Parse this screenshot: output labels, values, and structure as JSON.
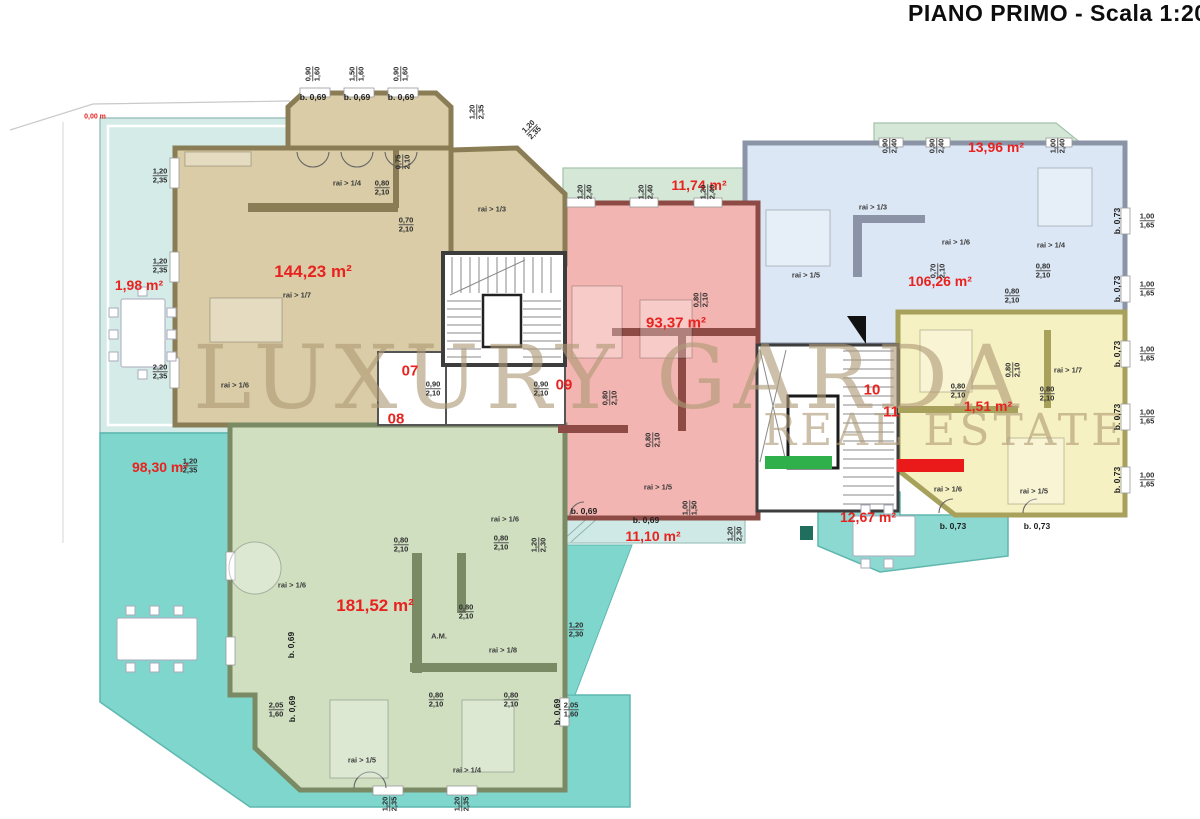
{
  "title": "PIANO PRIMO - Scala 1:200",
  "watermark": {
    "line1": "LUXURY GARDA",
    "line2": "REAL ESTATE"
  },
  "legend": {
    "available_color": "#2fb04a",
    "sold_color": "#ea1a1a"
  },
  "colors": {
    "terrace_light": "#d4ebe8",
    "terrace_turquoise": "#7fd6cd",
    "terrace_green": "#d5e8d8",
    "terrace_mid": "#8cd9d1",
    "stair_wall": "#3d3d3d",
    "area_text": "#e8221f"
  },
  "units": [
    {
      "number": "07",
      "area": "144,23 m²",
      "fill": "#d9cca6",
      "wall": "#8a7c54"
    },
    {
      "number": "08",
      "area": "181,52 m²",
      "fill": "#cfdfc0",
      "wall": "#798a64"
    },
    {
      "number": "09",
      "area": "93,37 m²",
      "fill": "#f2b5b1",
      "wall": "#8e4a45"
    },
    {
      "number": "10",
      "area": "106,26 m²",
      "fill": "#dce7f5",
      "wall": "#8a94a6"
    },
    {
      "number": "11",
      "area": "1,51 m²",
      "fill": "#f6f1c2",
      "wall": "#a8a15c"
    }
  ],
  "terrace_areas": [
    "1,98 m²",
    "98,30 m²",
    "11,74 m²",
    "13,96 m²",
    "11,10 m²",
    "12,67 m²",
    "0,00 m"
  ],
  "labels": {
    "areas": [
      {
        "t": "144,23 m²",
        "x": 313,
        "y": 272,
        "fs": 17
      },
      {
        "t": "181,52 m²",
        "x": 375,
        "y": 606,
        "fs": 17
      },
      {
        "t": "93,37 m²",
        "x": 676,
        "y": 323,
        "fs": 15
      },
      {
        "t": "106,26 m²",
        "x": 940,
        "y": 281,
        "fs": 14
      },
      {
        "t": "13,96 m²",
        "x": 996,
        "y": 147,
        "fs": 14
      },
      {
        "t": "11,74 m²",
        "x": 699,
        "y": 185,
        "fs": 14
      },
      {
        "t": "1,98 m²",
        "x": 139,
        "y": 285,
        "fs": 14
      },
      {
        "t": "98,30 m²",
        "x": 160,
        "y": 467,
        "fs": 14
      },
      {
        "t": "11,10 m²",
        "x": 653,
        "y": 536,
        "fs": 14
      },
      {
        "t": "12,67 m²",
        "x": 868,
        "y": 517,
        "fs": 14
      },
      {
        "t": "1,51 m²",
        "x": 988,
        "y": 406,
        "fs": 14
      },
      {
        "t": "0,00 m",
        "x": 95,
        "y": 117,
        "fs": 7
      }
    ],
    "unit_numbers": [
      {
        "t": "07",
        "x": 410,
        "y": 371
      },
      {
        "t": "08",
        "x": 396,
        "y": 419
      },
      {
        "t": "09",
        "x": 564,
        "y": 385
      },
      {
        "t": "10",
        "x": 872,
        "y": 390
      },
      {
        "t": "11",
        "x": 891,
        "y": 412
      }
    ],
    "rai": [
      {
        "t": "rai > 1/4",
        "x": 347,
        "y": 183
      },
      {
        "t": "rai > 1/3",
        "x": 492,
        "y": 209
      },
      {
        "t": "rai > 1/7",
        "x": 297,
        "y": 295
      },
      {
        "t": "rai > 1/6",
        "x": 235,
        "y": 385
      },
      {
        "t": "rai > 1/6",
        "x": 505,
        "y": 519
      },
      {
        "t": "rai > 1/6",
        "x": 292,
        "y": 585
      },
      {
        "t": "rai > 1/8",
        "x": 503,
        "y": 650
      },
      {
        "t": "rai > 1/5",
        "x": 362,
        "y": 760
      },
      {
        "t": "rai > 1/4",
        "x": 467,
        "y": 770
      },
      {
        "t": "A.M.",
        "x": 439,
        "y": 636
      },
      {
        "t": "rai > 1/5",
        "x": 658,
        "y": 487
      },
      {
        "t": "rai > 1/3",
        "x": 873,
        "y": 207
      },
      {
        "t": "rai > 1/5",
        "x": 806,
        "y": 275
      },
      {
        "t": "rai > 1/6",
        "x": 956,
        "y": 242
      },
      {
        "t": "rai > 1/4",
        "x": 1051,
        "y": 245
      },
      {
        "t": "rai > 1/7",
        "x": 1068,
        "y": 370
      },
      {
        "t": "rai > 1/6",
        "x": 948,
        "y": 489
      },
      {
        "t": "rai > 1/5",
        "x": 1034,
        "y": 491
      }
    ],
    "doors": [
      {
        "t": "b. 0,69",
        "x": 313,
        "y": 97
      },
      {
        "t": "b. 0,69",
        "x": 357,
        "y": 97
      },
      {
        "t": "b. 0,69",
        "x": 401,
        "y": 97
      },
      {
        "t": "b. 0,69",
        "x": 584,
        "y": 511
      },
      {
        "t": "b. 0,69",
        "x": 646,
        "y": 520
      },
      {
        "t": "b. 0,69",
        "x": 291,
        "y": 645,
        "r": -90
      },
      {
        "t": "b. 0,69",
        "x": 292,
        "y": 709,
        "r": -90
      },
      {
        "t": "b. 0,69",
        "x": 557,
        "y": 712,
        "r": -90
      },
      {
        "t": "b. 0,73",
        "x": 953,
        "y": 526
      },
      {
        "t": "b. 0,73",
        "x": 1037,
        "y": 526
      },
      {
        "t": "b. 0,73",
        "x": 1117,
        "y": 221,
        "r": -90
      },
      {
        "t": "b. 0,73",
        "x": 1117,
        "y": 289,
        "r": -90
      },
      {
        "t": "b. 0,73",
        "x": 1117,
        "y": 354,
        "r": -90
      },
      {
        "t": "b. 0,73",
        "x": 1117,
        "y": 417,
        "r": -90
      },
      {
        "t": "b. 0,73",
        "x": 1117,
        "y": 480,
        "r": -90
      }
    ],
    "dims": [
      {
        "a": "0,90",
        "b": "1,60",
        "x": 313,
        "y": 74,
        "r": -90
      },
      {
        "a": "1,50",
        "b": "1,60",
        "x": 357,
        "y": 74,
        "r": -90
      },
      {
        "a": "0,90",
        "b": "1,60",
        "x": 401,
        "y": 74,
        "r": -90
      },
      {
        "a": "1,20",
        "b": "2,35",
        "x": 477,
        "y": 112,
        "r": -90
      },
      {
        "a": "1,20",
        "b": "2,35",
        "x": 532,
        "y": 130,
        "r": -45
      },
      {
        "a": "1,20",
        "b": "2,35",
        "x": 160,
        "y": 176
      },
      {
        "a": "1,20",
        "b": "2,35",
        "x": 160,
        "y": 266
      },
      {
        "a": "2,20",
        "b": "2,35",
        "x": 160,
        "y": 372
      },
      {
        "a": "1,20",
        "b": "2,35",
        "x": 190,
        "y": 466
      },
      {
        "a": "1,20",
        "b": "2,40",
        "x": 585,
        "y": 192,
        "r": -90
      },
      {
        "a": "1,20",
        "b": "2,40",
        "x": 646,
        "y": 192,
        "r": -90
      },
      {
        "a": "1,20",
        "b": "2,40",
        "x": 708,
        "y": 192,
        "r": -90
      },
      {
        "a": "0,90",
        "b": "2,40",
        "x": 890,
        "y": 146,
        "r": -90
      },
      {
        "a": "0,90",
        "b": "2,40",
        "x": 937,
        "y": 146,
        "r": -90
      },
      {
        "a": "1,00",
        "b": "2,40",
        "x": 1058,
        "y": 146,
        "r": -90
      },
      {
        "a": "1,00",
        "b": "1,65",
        "x": 1147,
        "y": 221
      },
      {
        "a": "1,00",
        "b": "1,65",
        "x": 1147,
        "y": 289
      },
      {
        "a": "1,00",
        "b": "1,65",
        "x": 1147,
        "y": 354
      },
      {
        "a": "1,00",
        "b": "1,65",
        "x": 1147,
        "y": 417
      },
      {
        "a": "1,00",
        "b": "1,65",
        "x": 1147,
        "y": 480
      },
      {
        "a": "0,80",
        "b": "2,10",
        "x": 382,
        "y": 188
      },
      {
        "a": "0,70",
        "b": "2,10",
        "x": 406,
        "y": 225
      },
      {
        "a": "0,75",
        "b": "2,10",
        "x": 403,
        "y": 162,
        "r": -90
      },
      {
        "a": "0,90",
        "b": "2,10",
        "x": 433,
        "y": 389
      },
      {
        "a": "0,90",
        "b": "2,10",
        "x": 541,
        "y": 389
      },
      {
        "a": "0,80",
        "b": "2,10",
        "x": 610,
        "y": 398,
        "r": -90
      },
      {
        "a": "0,80",
        "b": "2,10",
        "x": 653,
        "y": 440,
        "r": -90
      },
      {
        "a": "0,80",
        "b": "2,10",
        "x": 701,
        "y": 300,
        "r": -90
      },
      {
        "a": "0,70",
        "b": "2,10",
        "x": 938,
        "y": 271,
        "r": -90
      },
      {
        "a": "0,80",
        "b": "2,10",
        "x": 1043,
        "y": 271
      },
      {
        "a": "0,80",
        "b": "2,10",
        "x": 1012,
        "y": 296
      },
      {
        "a": "0,80",
        "b": "2,10",
        "x": 401,
        "y": 545
      },
      {
        "a": "0,80",
        "b": "2,10",
        "x": 501,
        "y": 543
      },
      {
        "a": "0,80",
        "b": "2,10",
        "x": 466,
        "y": 612
      },
      {
        "a": "0,80",
        "b": "2,10",
        "x": 436,
        "y": 700
      },
      {
        "a": "0,80",
        "b": "2,10",
        "x": 511,
        "y": 700
      },
      {
        "a": "2,05",
        "b": "1,60",
        "x": 276,
        "y": 710
      },
      {
        "a": "2,05",
        "b": "1,60",
        "x": 571,
        "y": 710
      },
      {
        "a": "1,20",
        "b": "2,35",
        "x": 390,
        "y": 804,
        "r": -90
      },
      {
        "a": "1,20",
        "b": "2,35",
        "x": 462,
        "y": 804,
        "r": -90
      },
      {
        "a": "1,20",
        "b": "2,30",
        "x": 539,
        "y": 545,
        "r": -90
      },
      {
        "a": "1,20",
        "b": "2,30",
        "x": 576,
        "y": 630
      },
      {
        "a": "1,00",
        "b": "1,50",
        "x": 690,
        "y": 508,
        "r": -90
      },
      {
        "a": "1,20",
        "b": "2,30",
        "x": 735,
        "y": 534,
        "r": -90
      },
      {
        "a": "0,80",
        "b": "2,10",
        "x": 1013,
        "y": 370,
        "r": -90
      },
      {
        "a": "0,80",
        "b": "2,10",
        "x": 958,
        "y": 391
      },
      {
        "a": "0,80",
        "b": "2,10",
        "x": 1047,
        "y": 394
      }
    ]
  }
}
